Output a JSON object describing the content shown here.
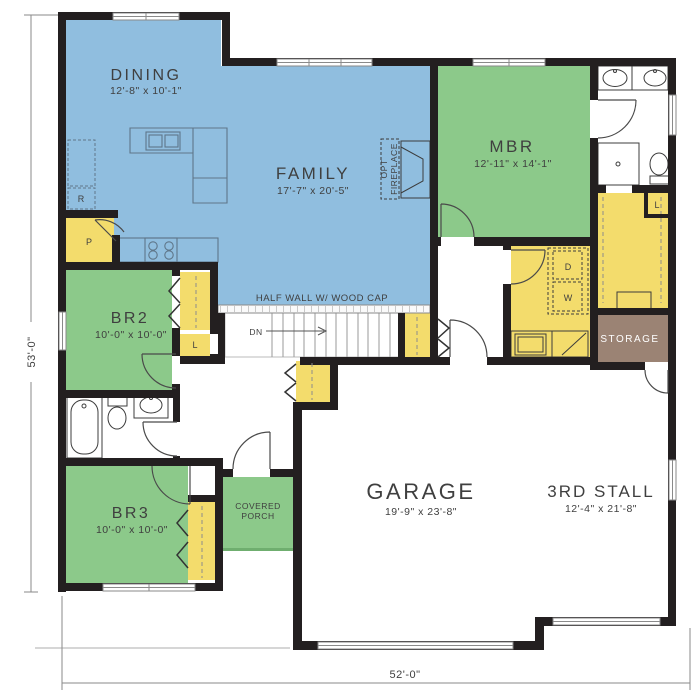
{
  "plan": {
    "rooms": {
      "dining": {
        "name": "DINING",
        "dims": "12'-8\" x 10'-1\""
      },
      "family": {
        "name": "FAMILY",
        "dims": "17'-7\" x 20'-5\""
      },
      "mbr": {
        "name": "MBR",
        "dims": "12'-11\" x 14'-1\""
      },
      "br2": {
        "name": "BR2",
        "dims": "10'-0\" x 10'-0\""
      },
      "br3": {
        "name": "BR3",
        "dims": "10'-0\" x 10'-0\""
      },
      "garage": {
        "name": "GARAGE",
        "dims": "19'-9\" x 23'-8\""
      },
      "third_stall": {
        "name": "3RD STALL",
        "dims": "12'-4\" x 21'-8\""
      },
      "storage": {
        "name": "STORAGE"
      },
      "porch": {
        "line1": "COVERED",
        "line2": "PORCH"
      }
    },
    "annotations": {
      "half_wall": "HALF WALL W/ WOOD CAP",
      "fireplace_line1": "OPT",
      "fireplace_line2": "FIREPLACE",
      "stairs_down": "DN"
    },
    "fixture_letters": {
      "dryer": "D",
      "washer": "W",
      "linen_hall": "L",
      "linen_master": "L",
      "pantry": "P",
      "refrigerator": "R"
    },
    "overall_dimensions": {
      "width": "52'-0\"",
      "depth": "53'-0\""
    },
    "colors": {
      "living_blue": "#90bedf",
      "bedroom_green": "#8cc98a",
      "closet_yellow": "#f3dc6c",
      "storage_brown": "#9b8374",
      "porch_green": "#8cc98a",
      "wall_black": "#231f20",
      "dimension_gray": "#8a8a8a",
      "label_dark": "#3f3f3f"
    }
  }
}
